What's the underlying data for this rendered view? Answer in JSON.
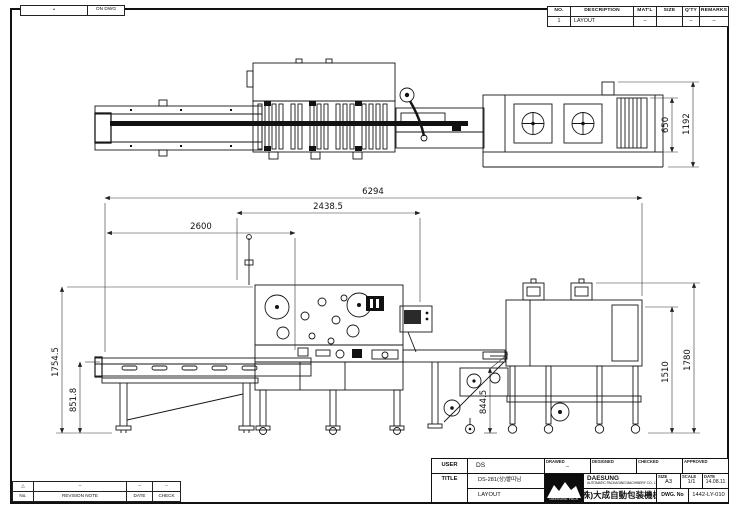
{
  "sheet": {
    "on_dwg": {
      "left_mark": "•",
      "label": "ON DWG"
    },
    "parts_table": {
      "headers": [
        "NO.",
        "DESCRIPTION",
        "MAT'L",
        "SIZE",
        "Q'TY",
        "REMARKS"
      ],
      "row": {
        "no": "1",
        "description": "LAYOUT",
        "matl": "–",
        "size": "",
        "qty": "–",
        "remarks": "–"
      }
    },
    "dimensions": {
      "overall_length": "6294",
      "wrapper_length": "2438.5",
      "infeed_length": "2600",
      "overall_height": "1754.5",
      "belt_height": "851.8",
      "discharge_height": "844.5",
      "tunnel_height": "1510",
      "tunnel_overall_height": "1780",
      "top_view_width": "650",
      "top_view_overall_width": "1192"
    },
    "revision_table": {
      "headers": [
        "No.",
        "REVISION NOTE",
        "DATE",
        "CHECK"
      ],
      "row": [
        "△",
        "–",
        "–",
        "–"
      ]
    },
    "title_block": {
      "user_label": "USER",
      "user": "DS",
      "title_label": "TITLE",
      "title_line1": "DS-281(상)빨띠님",
      "title_line2": "LAYOUT",
      "drawed_label": "DRAWED",
      "drawed_sign": "–",
      "designed_label": "DESIGNED",
      "checked_label": "CHECKED",
      "approved_label": "APPROVED",
      "logo_text": "DAESUNG PACK",
      "company_name": "DAESUNG",
      "company_sub": "AUTOMATIC PACKAGING MACHINERY CO., LTD.",
      "company_cjk": "(株)大成自動包装機械",
      "size_label": "SIZE",
      "size": "A3",
      "scale_label": "SCALE",
      "scale": "1/1",
      "date_label": "DATE",
      "date": "14.08.11",
      "dwg_no_label": "DWG. No",
      "dwg_no": "1442-LY-010"
    }
  }
}
